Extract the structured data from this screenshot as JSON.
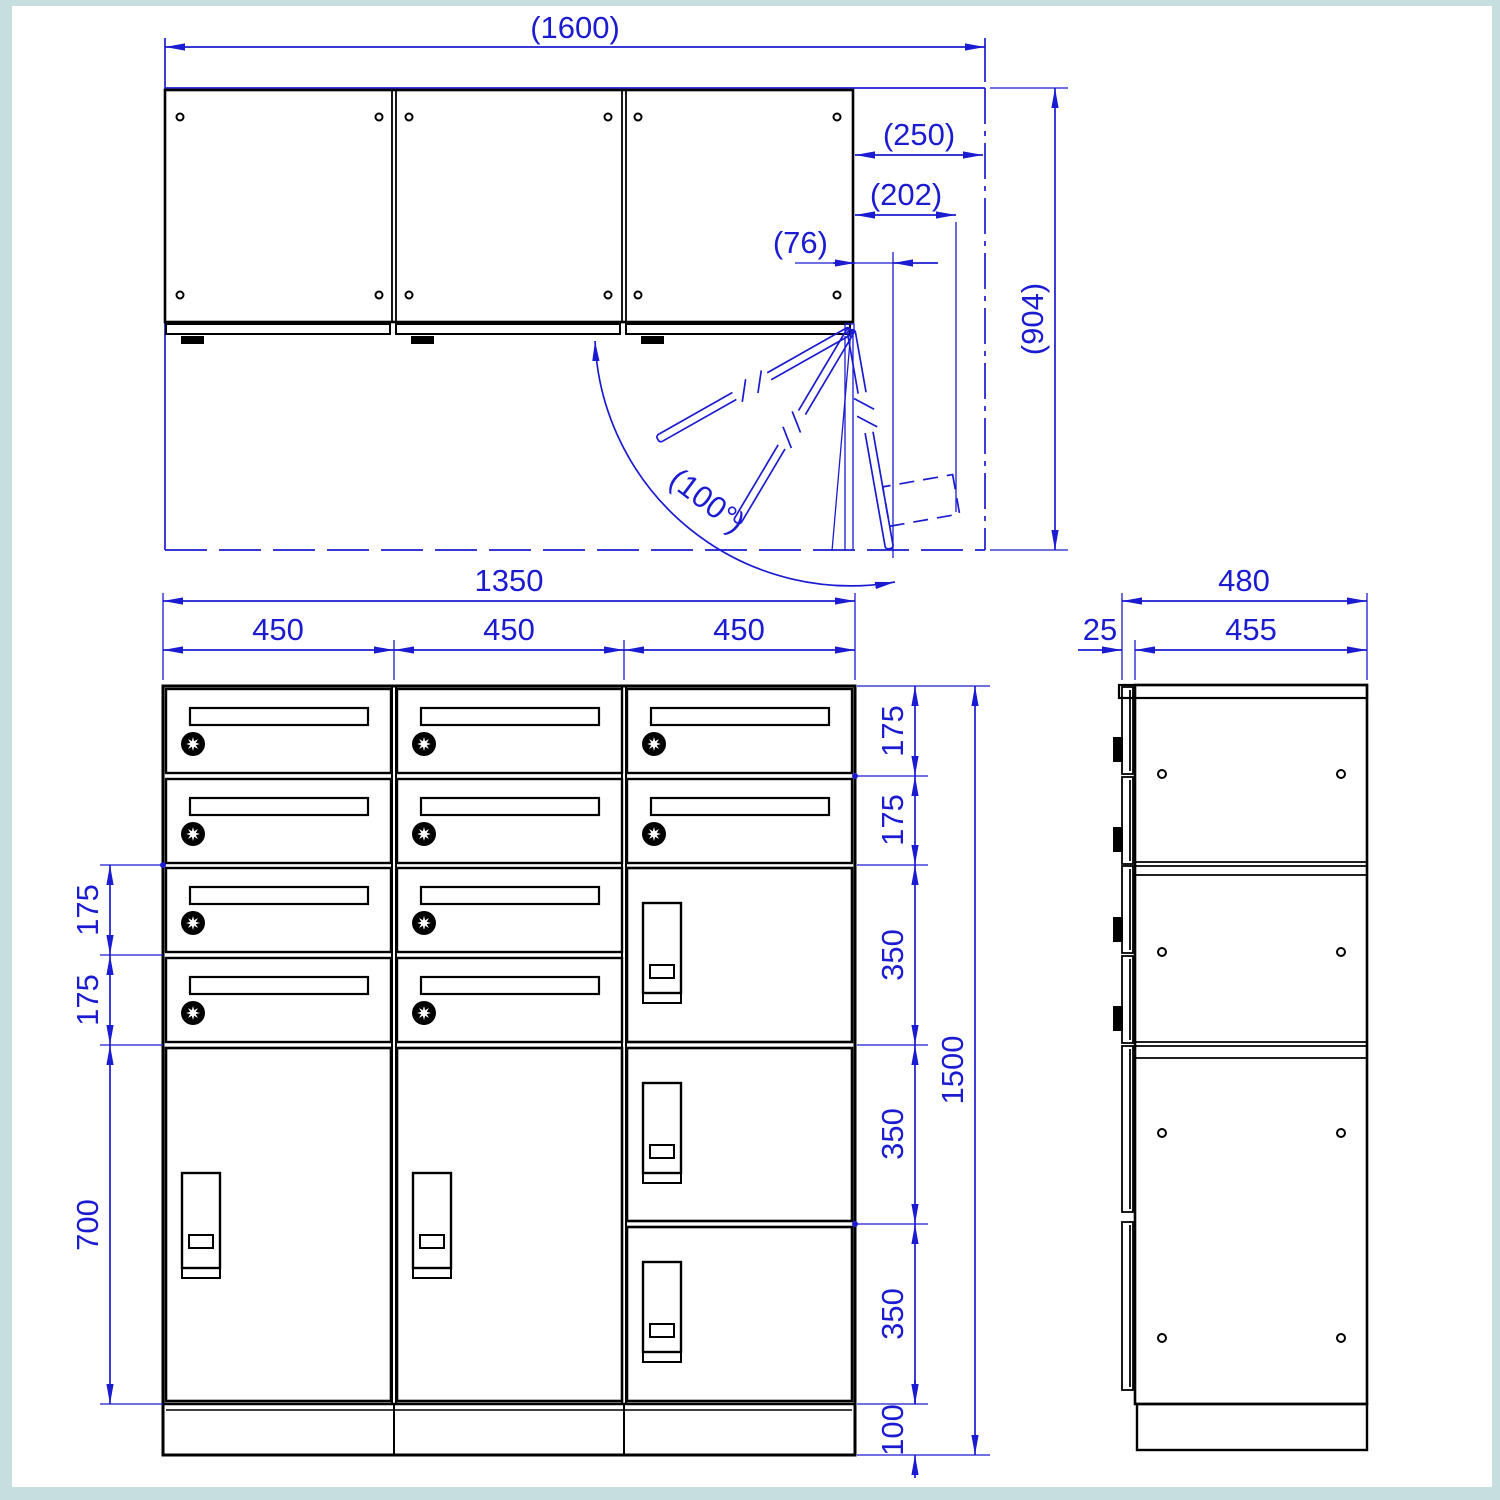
{
  "drawing": {
    "type": "technical-drawing",
    "subject": "mailbox-parcel-locker-cabinet",
    "views": [
      "top-view",
      "front-view",
      "side-view"
    ],
    "colors": {
      "lines": "#000000",
      "dimensions": "#1b1bd1",
      "paper": "#ffffff",
      "frame": "#c6dedd"
    }
  },
  "top": {
    "d1600": "(1600)",
    "d250": "(250)",
    "d202": "(202)",
    "d76": "(76)",
    "d904": "(904)",
    "angle": "(100°)"
  },
  "front": {
    "d1350": "1350",
    "c450a": "450",
    "c450b": "450",
    "c450c": "450",
    "L175a": "175",
    "L175b": "175",
    "L700": "700",
    "R175a": "175",
    "R175b": "175",
    "R350a": "350",
    "R350b": "350",
    "R350c": "350",
    "R100": "100",
    "R1500": "1500"
  },
  "side": {
    "d480": "480",
    "d455": "455",
    "d25": "25"
  }
}
